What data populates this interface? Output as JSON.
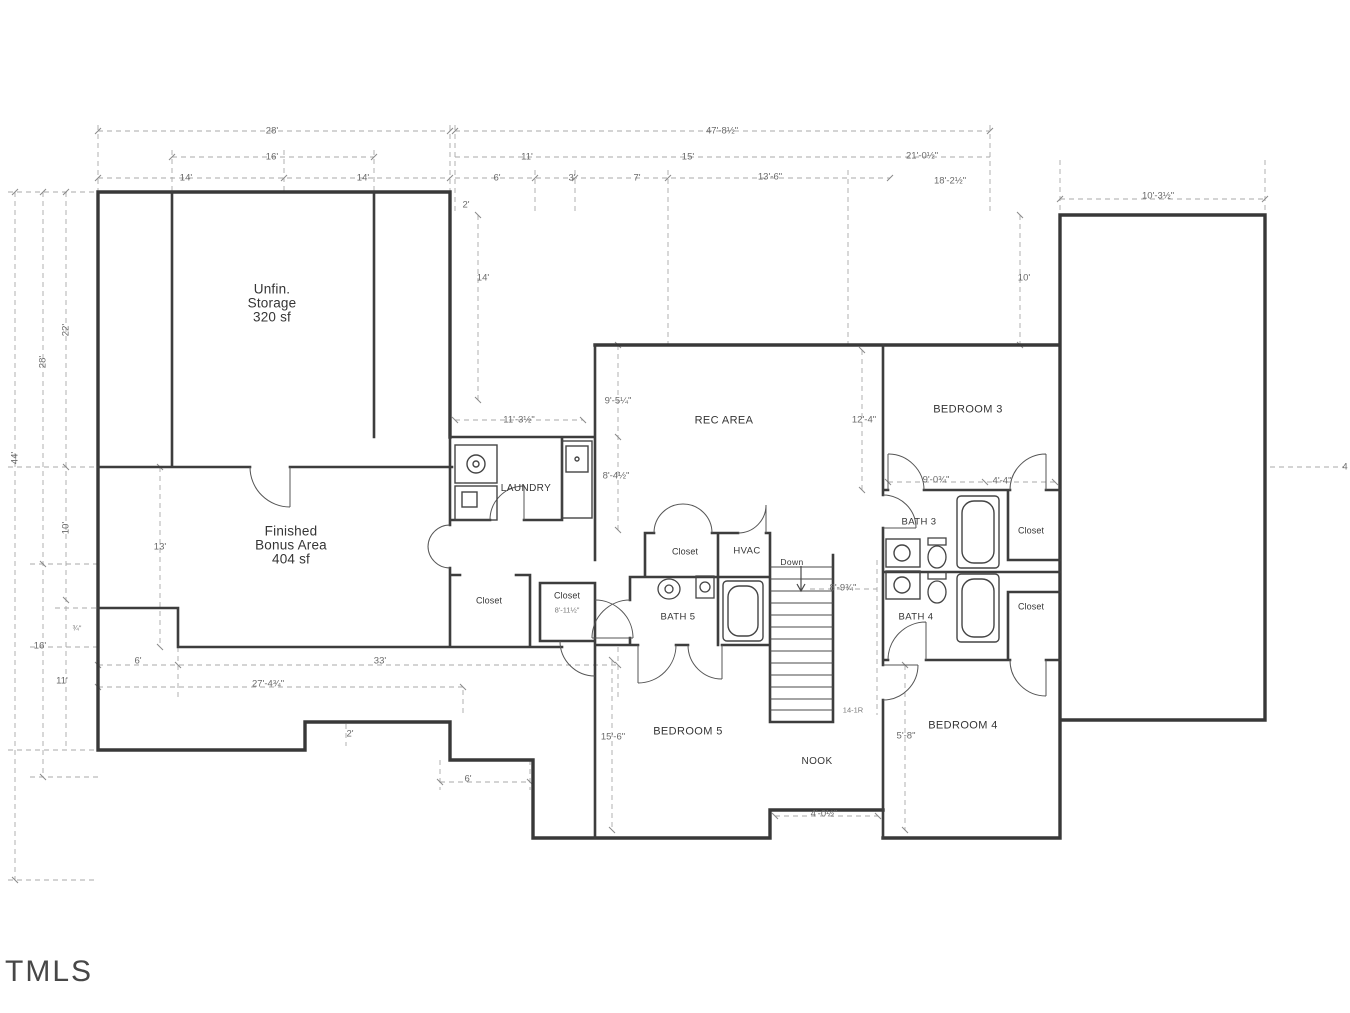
{
  "watermark": "TMLS",
  "rooms": {
    "unfin1": "Unfin.",
    "unfin2": "Storage",
    "unfin3": "320 sf",
    "bonus1": "Finished",
    "bonus2": "Bonus Area",
    "bonus3": "404 sf",
    "laundry": "LAUNDRY",
    "rec": "REC AREA",
    "bed3": "BEDROOM 3",
    "bed4": "BEDROOM 4",
    "bed5": "BEDROOM 5",
    "bath3": "BATH 3",
    "bath4": "BATH 4",
    "bath5": "BATH 5",
    "nook": "NOOK",
    "hvac": "HVAC",
    "closet_hall": "Closet",
    "closet_small": "Closet",
    "closet_rec": "Closet",
    "closet_b3a": "Closet",
    "closet_b3b": "Closet",
    "down": "Down",
    "stair_note": "14-1R"
  },
  "dims": {
    "t28": "28'",
    "t47": "47'-8½\"",
    "t16": "16'",
    "t11": "11'",
    "t15": "15'",
    "t21": "21'-0½\"",
    "t14a": "14'",
    "t14b": "14'",
    "t6": "6'",
    "t3": "3'",
    "t7": "7'",
    "t13_6": "13'-6\"",
    "t18": "18'-2½\"",
    "t10_3": "10'-3½\"",
    "t2": "2'",
    "attic14": "14'",
    "right10": "10'",
    "l44": "44'",
    "l28": "28'",
    "l22": "22'",
    "l10": "10'",
    "l34": "¾\"",
    "l16": "16'",
    "l11": "11'",
    "l13": "13'",
    "b6": "6'",
    "b33": "33'",
    "b27": "27'-4¾\"",
    "b2": "2'",
    "b6b": "6'",
    "m11_3": "11'-3½\"",
    "m9_5": "9'-5¼\"",
    "m8_4": "8'-4½\"",
    "m12_4": "12'-4\"",
    "m9_0": "9'-0¾\"",
    "m4_4": "4'-4\"",
    "m8_9": "8'-9¾\"",
    "m15_6": "15'-6\"",
    "m5_8": "5'-8\"",
    "m4_0": "4'-0½\"",
    "m8_11": "8'-11½\"",
    "r4": "4"
  }
}
